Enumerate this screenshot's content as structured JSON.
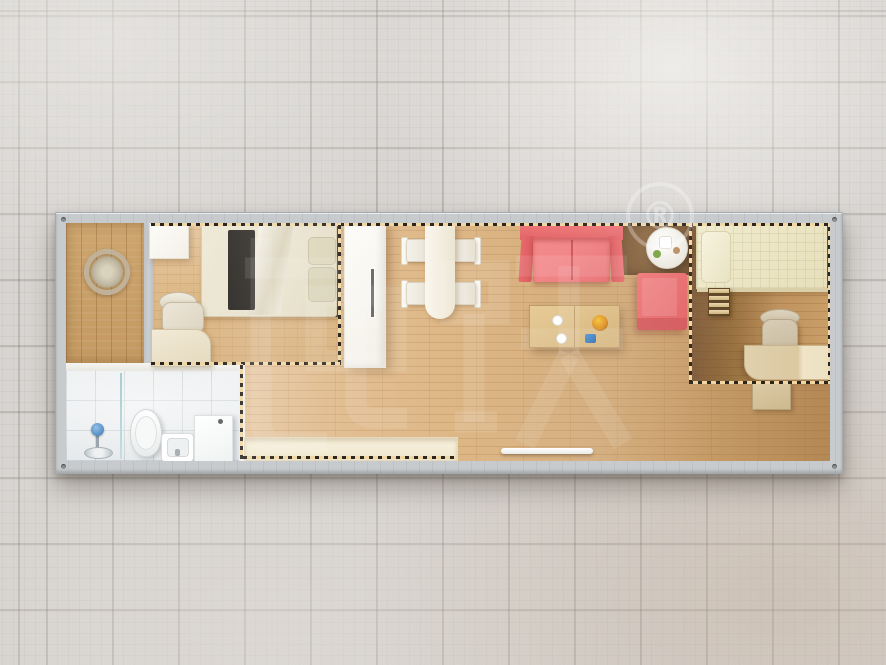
{
  "scene": {
    "type": "3d-floorplan-top-view",
    "description": "Top-down render of a single-module container house displayed on a gray tiled floor"
  },
  "watermark": {
    "characters": "柜族",
    "registered_mark": "®",
    "color": "#ffffff",
    "opacity": 0.1
  },
  "palette": {
    "tile_floor": "#d7d4d1",
    "tile_grout": "#b1adaa",
    "container_frame": "#c8cbcd",
    "living_wood": "#d9b383",
    "porch_wood": "#c89f68",
    "dark_walnut": "#7e5a38",
    "bathroom_tile": "#eef0f1",
    "sofa_red": "#ec7173",
    "bed_cream": "#e9e3cf",
    "quilt_cream": "#ece6c6",
    "partition_dash_fill": "#f0d7a4",
    "partition_dash_ink": "#2b251d",
    "white_furniture": "#f7f5ee"
  },
  "rooms": [
    {
      "name": "porch",
      "items": [
        "decor-wreath"
      ]
    },
    {
      "name": "bedroom-1",
      "items": [
        "storage-cabinet",
        "single-bed",
        "dark-runner",
        "pillows",
        "office-chair",
        "desk"
      ]
    },
    {
      "name": "bathroom",
      "items": [
        "shower-set",
        "glass-screen",
        "toilet",
        "wash-basin",
        "washing-machine"
      ]
    },
    {
      "name": "living-dining",
      "items": [
        "wardrobe",
        "dining-table",
        "dining-chairs-x4",
        "red-sofa",
        "coffee-table",
        "fruit-bowl",
        "round-side-table",
        "red-armchair",
        "bench-counter",
        "door-threshold",
        "dark-floor-mat"
      ]
    },
    {
      "name": "bedroom-2",
      "items": [
        "single-bed",
        "pillow",
        "step-ladder",
        "office-chair",
        "desk",
        "low-cabinet"
      ]
    }
  ]
}
